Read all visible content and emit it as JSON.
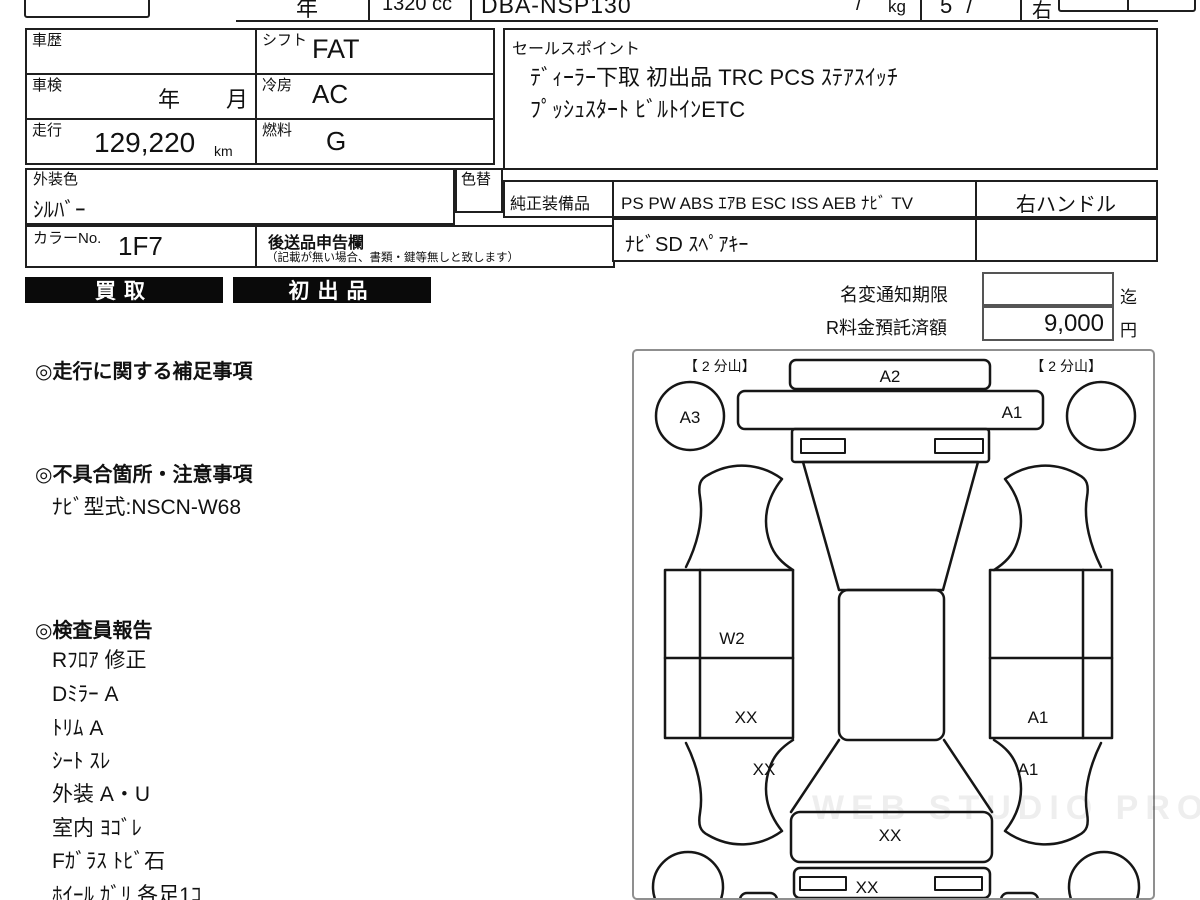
{
  "colors": {
    "badge_bg": "#0a0a0a",
    "badge_text": "#ffffff",
    "line": "#1f1f1f"
  },
  "header": {
    "year_label": "年",
    "displacement": "1320 cc",
    "model_code": "DBA-NSP130",
    "weight_value": "/",
    "weight_unit": "kg",
    "capacity_value": "5 /",
    "handle_value": "右"
  },
  "vehicle": {
    "history_label": "車歴",
    "shift_label": "シフト",
    "shift_value": "FAT",
    "inspection_label": "車検",
    "inspection_year": "年",
    "inspection_month": "月",
    "aircon_label": "冷房",
    "aircon_value": "AC",
    "mileage_label": "走行",
    "mileage_value": "129,220",
    "mileage_unit": "km",
    "fuel_label": "燃料",
    "fuel_value": "G",
    "color_label": "外装色",
    "color_value": "ｼﾙﾊﾞｰ",
    "color_change_label": "色替",
    "color_no_label": "カラーNo.",
    "color_no_value": "1F7",
    "late_items_label": "後送品申告欄",
    "late_items_note": "（記載が無い場合、書類・鍵等無しと致します）"
  },
  "sales_point": {
    "label": "セールスポイント",
    "line1": "ﾃﾞｨｰﾗｰ下取 初出品 TRC PCS ｽﾃｱｽｲｯﾁ",
    "line2": "ﾌﾟｯｼｭｽﾀｰﾄ ﾋﾞﾙﾄｲﾝETC"
  },
  "equipment": {
    "label": "純正装備品",
    "items": "PS PW ABS ｴｱB ESC ISS AEB ﾅﾋﾞ TV",
    "handle": "右ハンドル",
    "extra": "ﾅﾋﾞSD ｽﾍﾟｱｷｰ"
  },
  "badges": {
    "kaitori": "買取",
    "hatsushuppin": "初出品"
  },
  "notice": {
    "name_change_label": "名変通知期限",
    "name_change_value": "",
    "name_change_suffix": "迄",
    "recycle_label": "R料金預託済額",
    "recycle_value": "9,000",
    "recycle_unit": "円"
  },
  "sections": {
    "mileage_notes_title": "◎走行に関する補足事項",
    "defects_title": "◎不具合箇所・注意事項",
    "defects_line": "ﾅﾋﾞ型式:NSCN-W68",
    "inspector_title": "◎検査員報告",
    "inspector_items": [
      "Rﾌﾛｱ 修正",
      "Dﾐﾗｰ A",
      "ﾄﾘﾑ A",
      "ｼｰﾄ ｽﾚ",
      "外装 A・U",
      "室内 ﾖｺﾞﾚ",
      "Fｶﾞﾗｽ ﾄﾋﾞ石",
      "ﾎｲｰﾙ ｶﾞﾘ 各足1ｺ"
    ]
  },
  "diagram": {
    "corner_left": "【 2 分山】",
    "corner_right": "【 2 分山】",
    "labels": {
      "rear_bumper": "A2",
      "rear_left_wheel": "A3",
      "trunk": "A1",
      "left_quarter": "W2",
      "left_door": "XX",
      "left_front_fender": "XX",
      "right_door": "A1",
      "right_front_fender": "A1",
      "hood": "XX",
      "front_bumper": "XX"
    },
    "watermark": "WEB STUDIO PRO"
  }
}
